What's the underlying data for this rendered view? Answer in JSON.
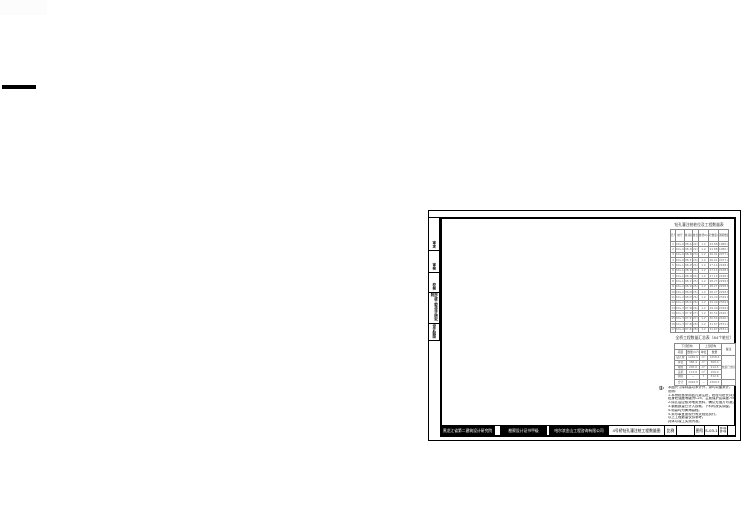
{
  "decorations": {
    "corner_block_color": "#fcfcfc",
    "left_bar_color": "#000000"
  },
  "sheet": {
    "border_color": "#000000",
    "side_tabs": [
      {
        "label": "审定"
      },
      {
        "label": "审核"
      },
      {
        "label": "校核"
      },
      {
        "label": "市政工程设计研究院"
      },
      {
        "label": "设计制图"
      }
    ],
    "table1": {
      "title": "钻孔灌注桩桩位及工程数量表",
      "headers": [
        "孔号",
        "桩号",
        "桩顶标高(m)",
        "桩长(m)",
        "桩径D(m)",
        "砼数量(m³)",
        "钢筋数量(kg)"
      ],
      "rows": [
        [
          "1",
          "K0+015.0",
          "98.42",
          "22.0",
          "1.2",
          "24.88",
          "1986.4"
        ],
        [
          "2",
          "K0+040.0",
          "98.40",
          "22.0",
          "1.2",
          "24.88",
          "1986.4"
        ],
        [
          "3",
          "K0+065.0",
          "98.36",
          "23.0",
          "1.2",
          "26.01",
          "2077.2"
        ],
        [
          "4",
          "K0+090.0",
          "98.31",
          "23.0",
          "1.2",
          "26.01",
          "2077.2"
        ],
        [
          "5",
          "K0+115.0",
          "98.25",
          "24.0",
          "1.2",
          "27.14",
          "2168.0"
        ],
        [
          "6",
          "K0+140.0",
          "98.20",
          "24.0",
          "1.2",
          "27.14",
          "2168.0"
        ],
        [
          "7",
          "K0+165.0",
          "98.16",
          "24.0",
          "1.2",
          "27.14",
          "2168.0"
        ],
        [
          "8",
          "K0+190.0",
          "98.13",
          "25.0",
          "1.2",
          "28.27",
          "2258.8"
        ],
        [
          "9",
          "K0+215.0",
          "98.10",
          "25.0",
          "1.2",
          "28.27",
          "2258.8"
        ],
        [
          "10",
          "K0+240.0",
          "98.08",
          "25.0",
          "1.2",
          "28.27",
          "2258.8"
        ],
        [
          "11",
          "K0+265.0",
          "98.05",
          "26.0",
          "1.2",
          "29.40",
          "2349.6"
        ],
        [
          "12",
          "K0+290.0",
          "98.02",
          "26.0",
          "1.2",
          "29.40",
          "2349.6"
        ],
        [
          "13",
          "K0+315.0",
          "97.98",
          "26.0",
          "1.2",
          "29.40",
          "2349.6"
        ],
        [
          "14",
          "K0+340.0",
          "97.95",
          "27.0",
          "1.2",
          "30.54",
          "2440.4"
        ],
        [
          "15",
          "K0+365.0",
          "97.91",
          "27.0",
          "1.2",
          "30.54",
          "2440.4"
        ],
        [
          "16",
          "K0+390.0",
          "97.88",
          "28.0",
          "1.2",
          "31.67",
          "2531.2"
        ],
        [
          "17",
          "K0+415.0",
          "97.84",
          "28.0",
          "1.2",
          "31.67",
          "2531.2"
        ]
      ]
    },
    "table2": {
      "title": "全桥工程数量汇总表（84个桩位）",
      "group_left": "下部结构",
      "group_right": "上部结构",
      "corner": "备注",
      "sub_headers": [
        "项目",
        "数量(m³)",
        "单位",
        "数量"
      ],
      "rows": [
        [
          "钻孔桩",
          "1260.0",
          "m³",
          "1258.4"
        ],
        [
          "承台",
          "386.4",
          "m³",
          "368.0"
        ],
        [
          "墩柱",
          "205.6",
          "m³",
          "214.5"
        ],
        [
          "盖梁",
          "174.8",
          "m³",
          "156.0"
        ],
        [
          "钢筋",
          "—",
          "t",
          "312.6"
        ]
      ],
      "note_cell": "数量已含损耗",
      "total_row": [
        "合计",
        "2026.8",
        "—",
        "2309.5"
      ],
      "total_note": ""
    },
    "notes": {
      "marker": "注:",
      "lines": [
        "本图尺寸除标高以米计外，余均以厘米计。",
        "说明：",
        "1.本桥桩基采用钻孔灌注桩，桩径与桩长详见本表。",
        "桩身砼强度等级为C25，主筋保护层厚度7cm。",
        "2.成孔后应核对地质资料，确认无误方可灌注。",
        "3.钢筋数量已计入损耗，下料时按实调整。",
        "4.标高均为黄海高程。",
        "5.未尽事宜按现行有关规范执行。",
        "以上工程数量仅供参考。",
        "具体以竣工实测为准。"
      ]
    },
    "title_bar": {
      "institute": "黑龙江省第二建筑设计研究院",
      "certificate": "勘察设计证书甲级",
      "company": "哈尔滨金山工程咨询有限公司",
      "project": "4号桥钻孔灌注桩工程数量图",
      "scale_label": "比例",
      "sheet_label": "图号",
      "sheet_no": "S-03-1",
      "pages_line1": "共1张",
      "pages_line2": "第1张"
    }
  }
}
